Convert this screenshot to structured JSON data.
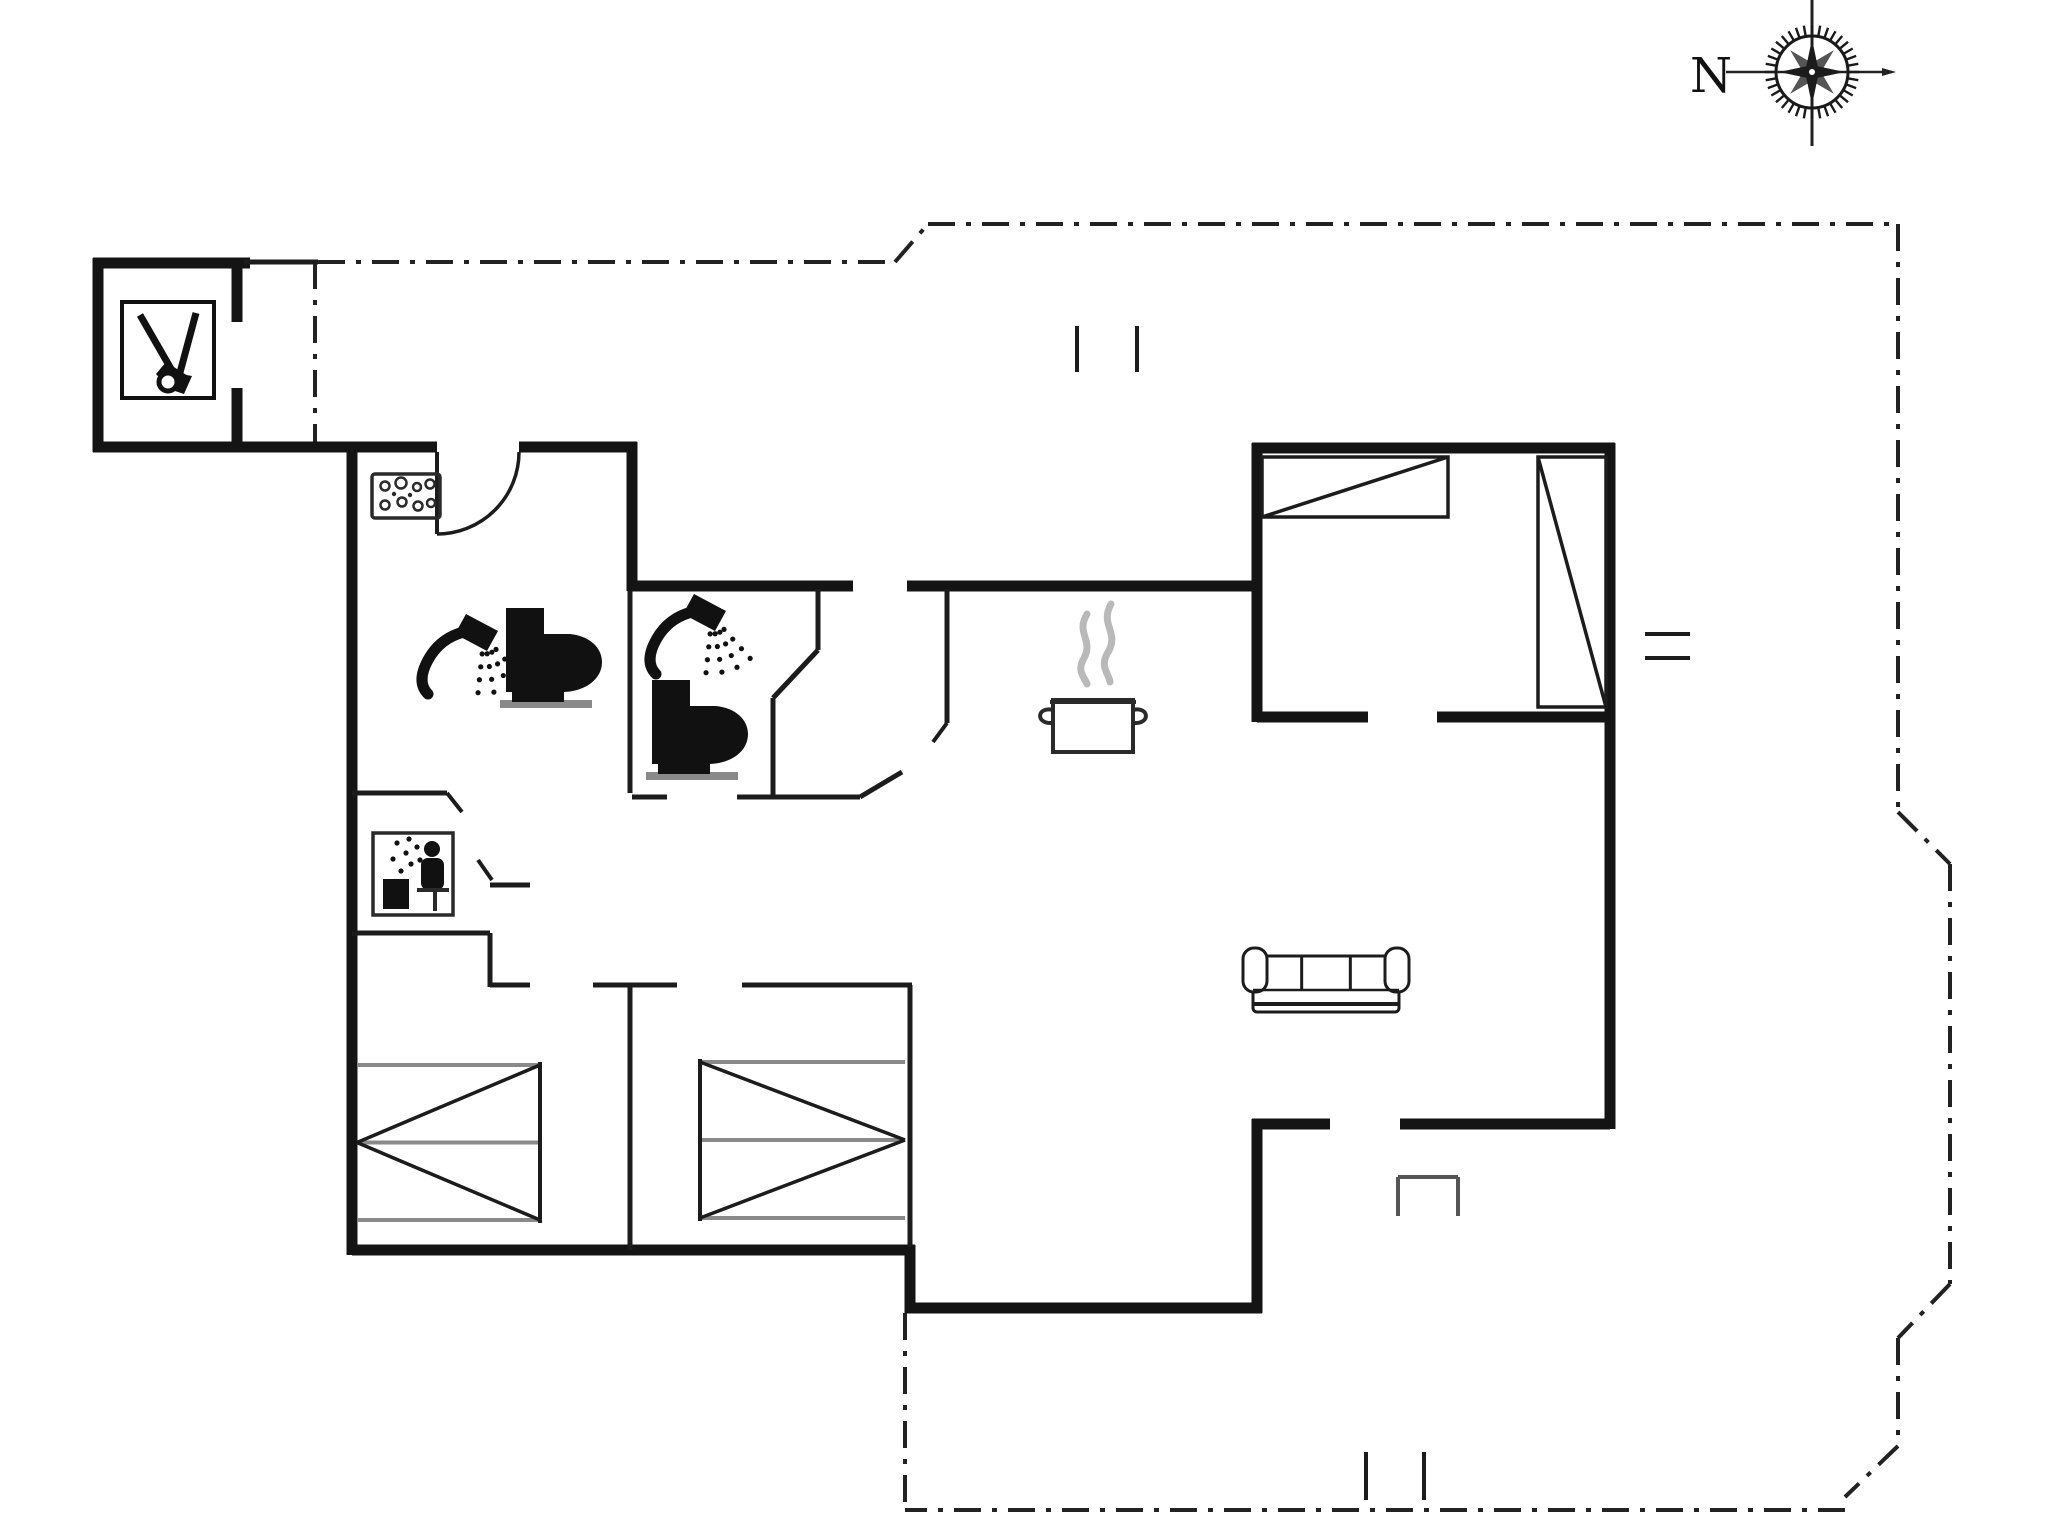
{
  "page": {
    "background": "#ffffff",
    "width": 2048,
    "height": 1536
  },
  "compass": {
    "label": "N",
    "cx": 1812,
    "cy": 72,
    "label_x": 1690,
    "label_y": 92,
    "font_size": 48
  },
  "colors": {
    "wall": "#141414",
    "thin_wall": "#1c1c1c",
    "dash": "#222222",
    "gray": "#8a8a8a",
    "steam": "#b9b9b9",
    "icon": "#111111"
  },
  "plan": {
    "thick_walls": [
      [
        93,
        263,
        250,
        263
      ],
      [
        98,
        258,
        98,
        452
      ],
      [
        237,
        263,
        237,
        322
      ],
      [
        237,
        388,
        237,
        452
      ],
      [
        93,
        447,
        437,
        447
      ],
      [
        519,
        447,
        637,
        447
      ],
      [
        632,
        442,
        632,
        591
      ],
      [
        632,
        586,
        853,
        586
      ],
      [
        907,
        586,
        1262,
        586
      ],
      [
        1257,
        443,
        1257,
        722
      ],
      [
        1252,
        448,
        1615,
        448
      ],
      [
        1610,
        443,
        1610,
        1129
      ],
      [
        1257,
        717,
        1368,
        717
      ],
      [
        1437,
        717,
        1615,
        717
      ],
      [
        1610,
        1124,
        1400,
        1124
      ],
      [
        1330,
        1124,
        1252,
        1124
      ],
      [
        1257,
        1119,
        1257,
        1313
      ],
      [
        1262,
        1308,
        905,
        1308
      ],
      [
        910,
        1313,
        910,
        1245
      ],
      [
        915,
        1250,
        352,
        1250
      ],
      [
        352,
        1255,
        352,
        443
      ]
    ],
    "thin_walls": [
      [
        244,
        262,
        318,
        262
      ],
      [
        630,
        591,
        630,
        793
      ],
      [
        352,
        793,
        447,
        793
      ],
      [
        352,
        933,
        490,
        933
      ],
      [
        490,
        933,
        490,
        987
      ],
      [
        490,
        985,
        530,
        985
      ],
      [
        593,
        985,
        677,
        985
      ],
      [
        742,
        985,
        912,
        985
      ],
      [
        630,
        985,
        630,
        1250
      ],
      [
        910,
        985,
        910,
        1247
      ],
      [
        632,
        797,
        667,
        797
      ],
      [
        737,
        797,
        860,
        797
      ],
      [
        818,
        589,
        818,
        650
      ],
      [
        818,
        650,
        773,
        698
      ],
      [
        773,
        698,
        773,
        797
      ],
      [
        860,
        797,
        902,
        772
      ],
      [
        947,
        589,
        947,
        723
      ],
      [
        490,
        885,
        530,
        885
      ]
    ],
    "door_leaves": [
      [
        447,
        793,
        462,
        812
      ],
      [
        478,
        860,
        492,
        880
      ],
      [
        947,
        723,
        933,
        742
      ],
      [
        437,
        452,
        437,
        534
      ]
    ],
    "door_arc": {
      "path": "M 519 452 A 82 82 0 0 1 437 534"
    },
    "dashed_outline": [
      [
        315,
        262,
        315,
        443
      ],
      [
        318,
        262,
        895,
        262
      ],
      [
        895,
        262,
        928,
        224
      ],
      [
        928,
        224,
        1898,
        224
      ],
      [
        1898,
        224,
        1898,
        812
      ],
      [
        1898,
        812,
        1950,
        864
      ],
      [
        1950,
        864,
        1950,
        1284
      ],
      [
        1950,
        1284,
        1898,
        1338
      ],
      [
        1898,
        1338,
        1898,
        1446
      ],
      [
        1898,
        1446,
        1845,
        1497
      ],
      [
        1845,
        1510,
        905,
        1510
      ],
      [
        905,
        1313,
        905,
        1510
      ]
    ],
    "tick_marks": [
      [
        1077,
        326,
        1077,
        372
      ],
      [
        1137,
        326,
        1137,
        372
      ],
      [
        1645,
        634,
        1690,
        634
      ],
      [
        1645,
        658,
        1690,
        658
      ],
      [
        1366,
        1452,
        1366,
        1500
      ],
      [
        1424,
        1452,
        1424,
        1500
      ]
    ],
    "step_marker": [
      [
        1398,
        1216,
        1398,
        1177
      ],
      [
        1398,
        1177,
        1458,
        1177
      ],
      [
        1458,
        1177,
        1458,
        1216
      ]
    ],
    "furniture": {
      "wardrobes": [
        {
          "x": 1262,
          "y": 457,
          "w": 186,
          "h": 60,
          "diag": "up"
        },
        {
          "x": 1538,
          "y": 457,
          "w": 68,
          "h": 250,
          "diag": "down"
        }
      ],
      "beds": [
        {
          "x": 357,
          "y": 1065,
          "w": 183,
          "h": 155,
          "point": "left"
        },
        {
          "x": 700,
          "y": 1062,
          "w": 205,
          "h": 156,
          "point": "right"
        }
      ],
      "sofa": {
        "x": 1247,
        "y": 948,
        "w": 158,
        "h": 64
      },
      "pot": {
        "x": 1053,
        "y": 688,
        "w": 80,
        "h": 58
      }
    },
    "icons": [
      {
        "type": "garden-tools-icon",
        "x": 122,
        "y": 302
      },
      {
        "type": "washing-machine-icon",
        "x": 372,
        "y": 474
      },
      {
        "type": "shower-icon",
        "x": 420,
        "y": 612
      },
      {
        "type": "toilet-icon",
        "x": 506,
        "y": 608
      },
      {
        "type": "shower-icon",
        "x": 648,
        "y": 592
      },
      {
        "type": "toilet-icon",
        "x": 652,
        "y": 680
      },
      {
        "type": "sauna-icon",
        "x": 373,
        "y": 833
      }
    ]
  }
}
